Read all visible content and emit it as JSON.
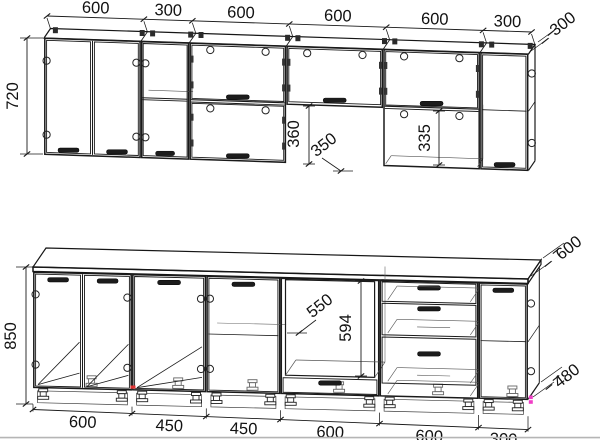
{
  "labels": {
    "upper_top_dims": [
      "600",
      "300",
      "600",
      "600",
      "600",
      "300"
    ],
    "upper_height": "720",
    "upper_cabinet_depth": "300",
    "open_gap_height": "360",
    "gap_annotation": "350",
    "upper_niche_height": "335",
    "base_height": "850",
    "countertop_depth": "600",
    "base_cabinet_depth": "480",
    "oven_niche_width": "550",
    "oven_niche_height": "594",
    "base_bottom_dims": [
      "600",
      "450",
      "450",
      "600",
      "600",
      "300"
    ]
  },
  "colors": {
    "line": "#1a1a1a",
    "background": "#ffffff",
    "artifact_red": "#e03131",
    "artifact_magenta": "#f03dc6"
  }
}
